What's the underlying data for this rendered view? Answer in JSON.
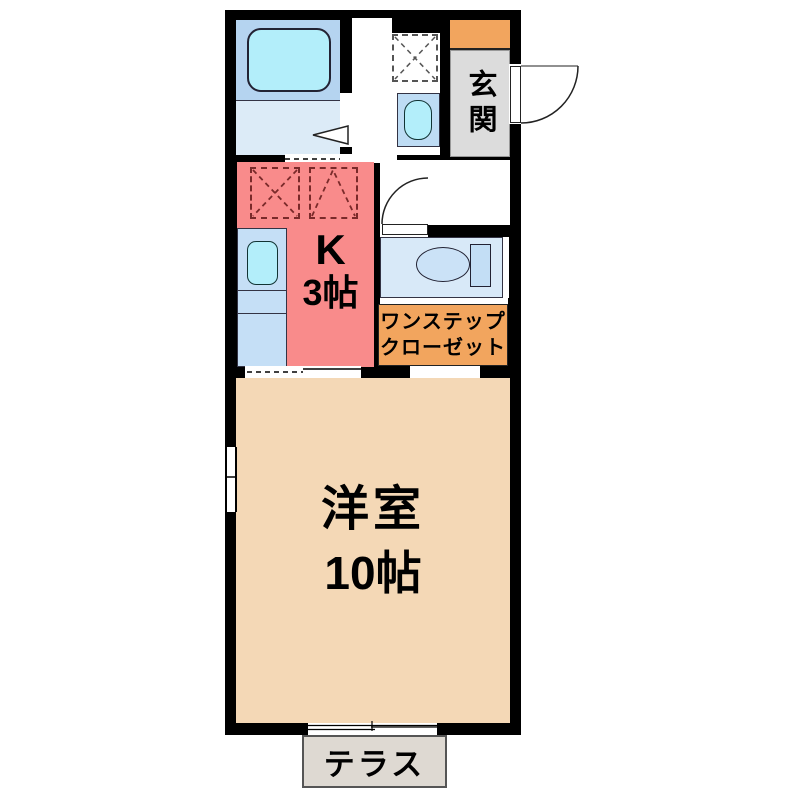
{
  "floor_plan": {
    "entrance": {
      "label": "玄関"
    },
    "kitchen": {
      "label": "K",
      "size_label": "3帖"
    },
    "closet": {
      "label_line1": "ワンステップ",
      "label_line2": "クローゼット"
    },
    "main_room": {
      "label": "洋室",
      "size_label": "10帖"
    },
    "terrace": {
      "label": "テラス"
    },
    "fixtures": [
      "bathtub",
      "washing-machine-pan",
      "wash-basin",
      "toilet",
      "kitchen-sink",
      "stove-burner-left",
      "stove-burner-right",
      "entrance-door-swing",
      "toilet-door-swing",
      "bathroom-folding-door",
      "left-wall-window",
      "terrace-sliding-door"
    ],
    "colors": {
      "wall": "#000000",
      "kitchen": "#f98b8b",
      "main_room": "#f4d8b6",
      "entrance_step": "#f2a55e",
      "closet": "#f2a55e",
      "entrance_floor": "#dcdcdc",
      "bathroom_upper": "#b5d4f0",
      "bathroom_floor": "#dcebf7",
      "fixture_cyan": "#b3eefa",
      "counter_blue": "#c5dff6",
      "toilet_room": "#d8e9f8",
      "terrace": "#ded9d2"
    }
  }
}
